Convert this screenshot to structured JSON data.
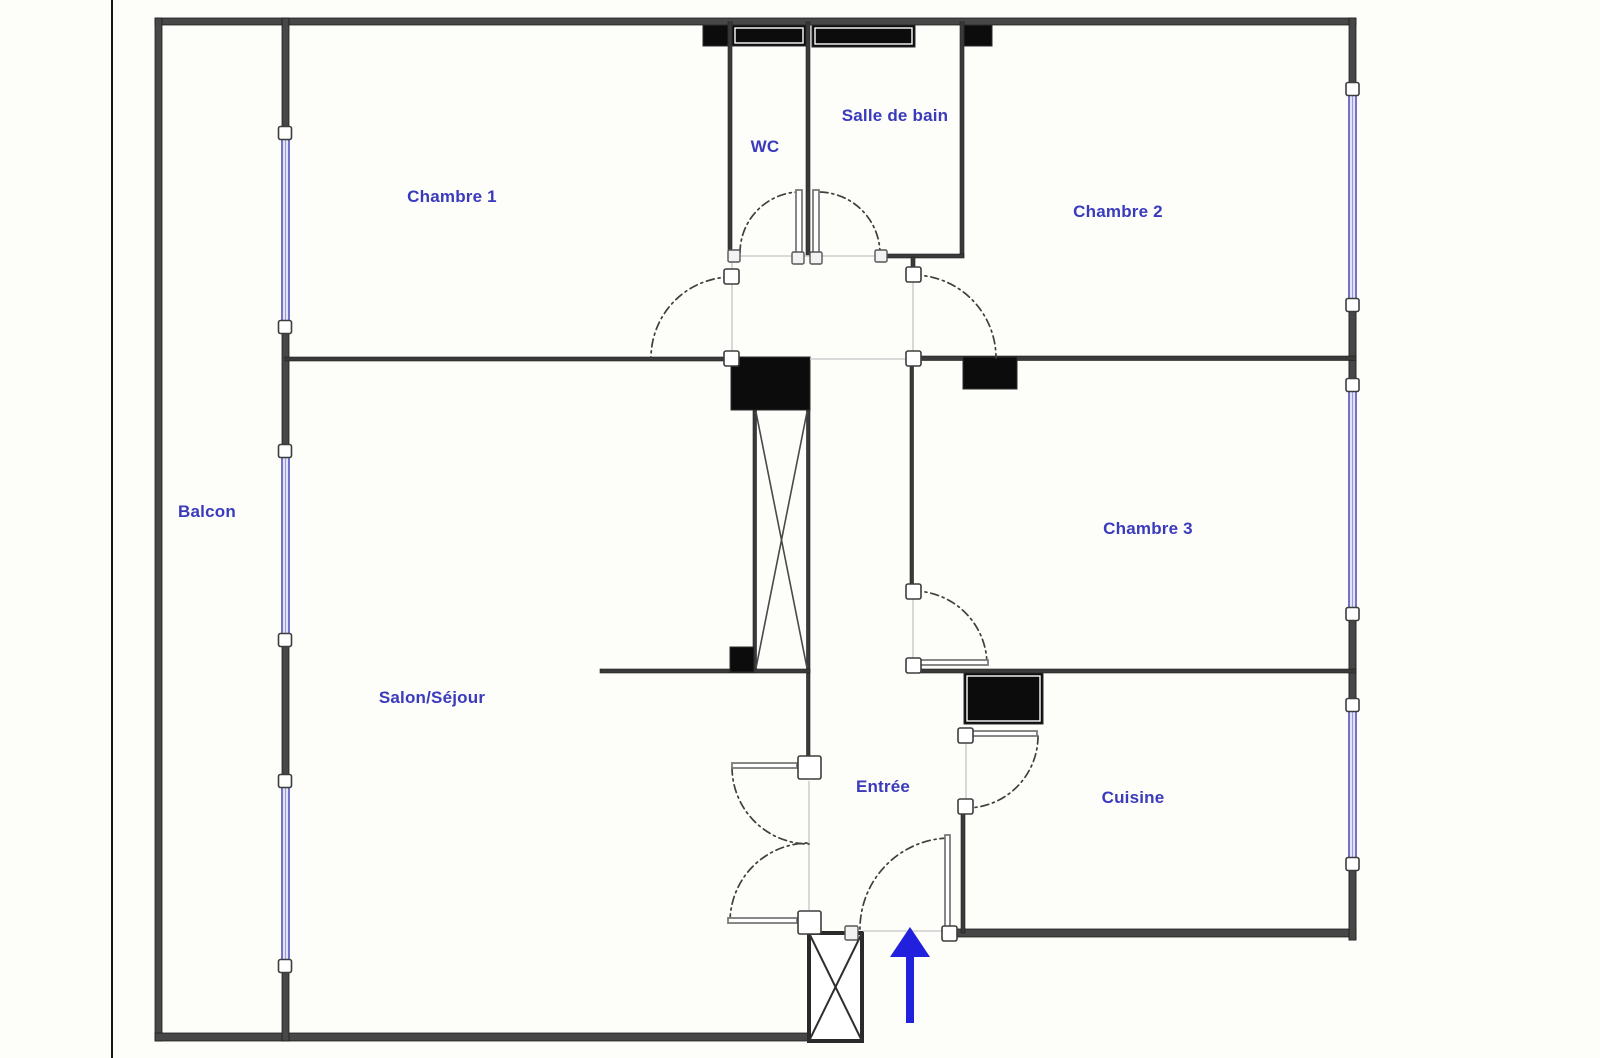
{
  "document": {
    "type": "apartment-floor-plan",
    "orientation_arrow": "entrance-arrow-up"
  },
  "colors": {
    "label_blue": "#3a3abc",
    "wall_gray": "#474747",
    "window_blue": "#7272c8",
    "window_fill": "#e3e3f5",
    "arrow_blue": "#2121dd",
    "fixture_black": "#0c0c0c",
    "background": "#fdfdfa"
  },
  "rooms": {
    "chambre1": {
      "label": "Chambre 1"
    },
    "wc": {
      "label": "WC"
    },
    "salle_de_bain": {
      "label": "Salle de bain"
    },
    "chambre2": {
      "label": "Chambre 2"
    },
    "balcon": {
      "label": "Balcon"
    },
    "salon_sejour": {
      "label": "Salon/Séjour"
    },
    "chambre3": {
      "label": "Chambre 3"
    },
    "entree": {
      "label": "Entrée"
    },
    "cuisine": {
      "label": "Cuisine"
    }
  },
  "features": {
    "windows_left_wall": 3,
    "windows_right_wall": 3,
    "elevator_shaft": "crossed-box-center",
    "entry_stair": "crossed-box-bottom",
    "entrance_direction_icon": "up-arrow"
  }
}
